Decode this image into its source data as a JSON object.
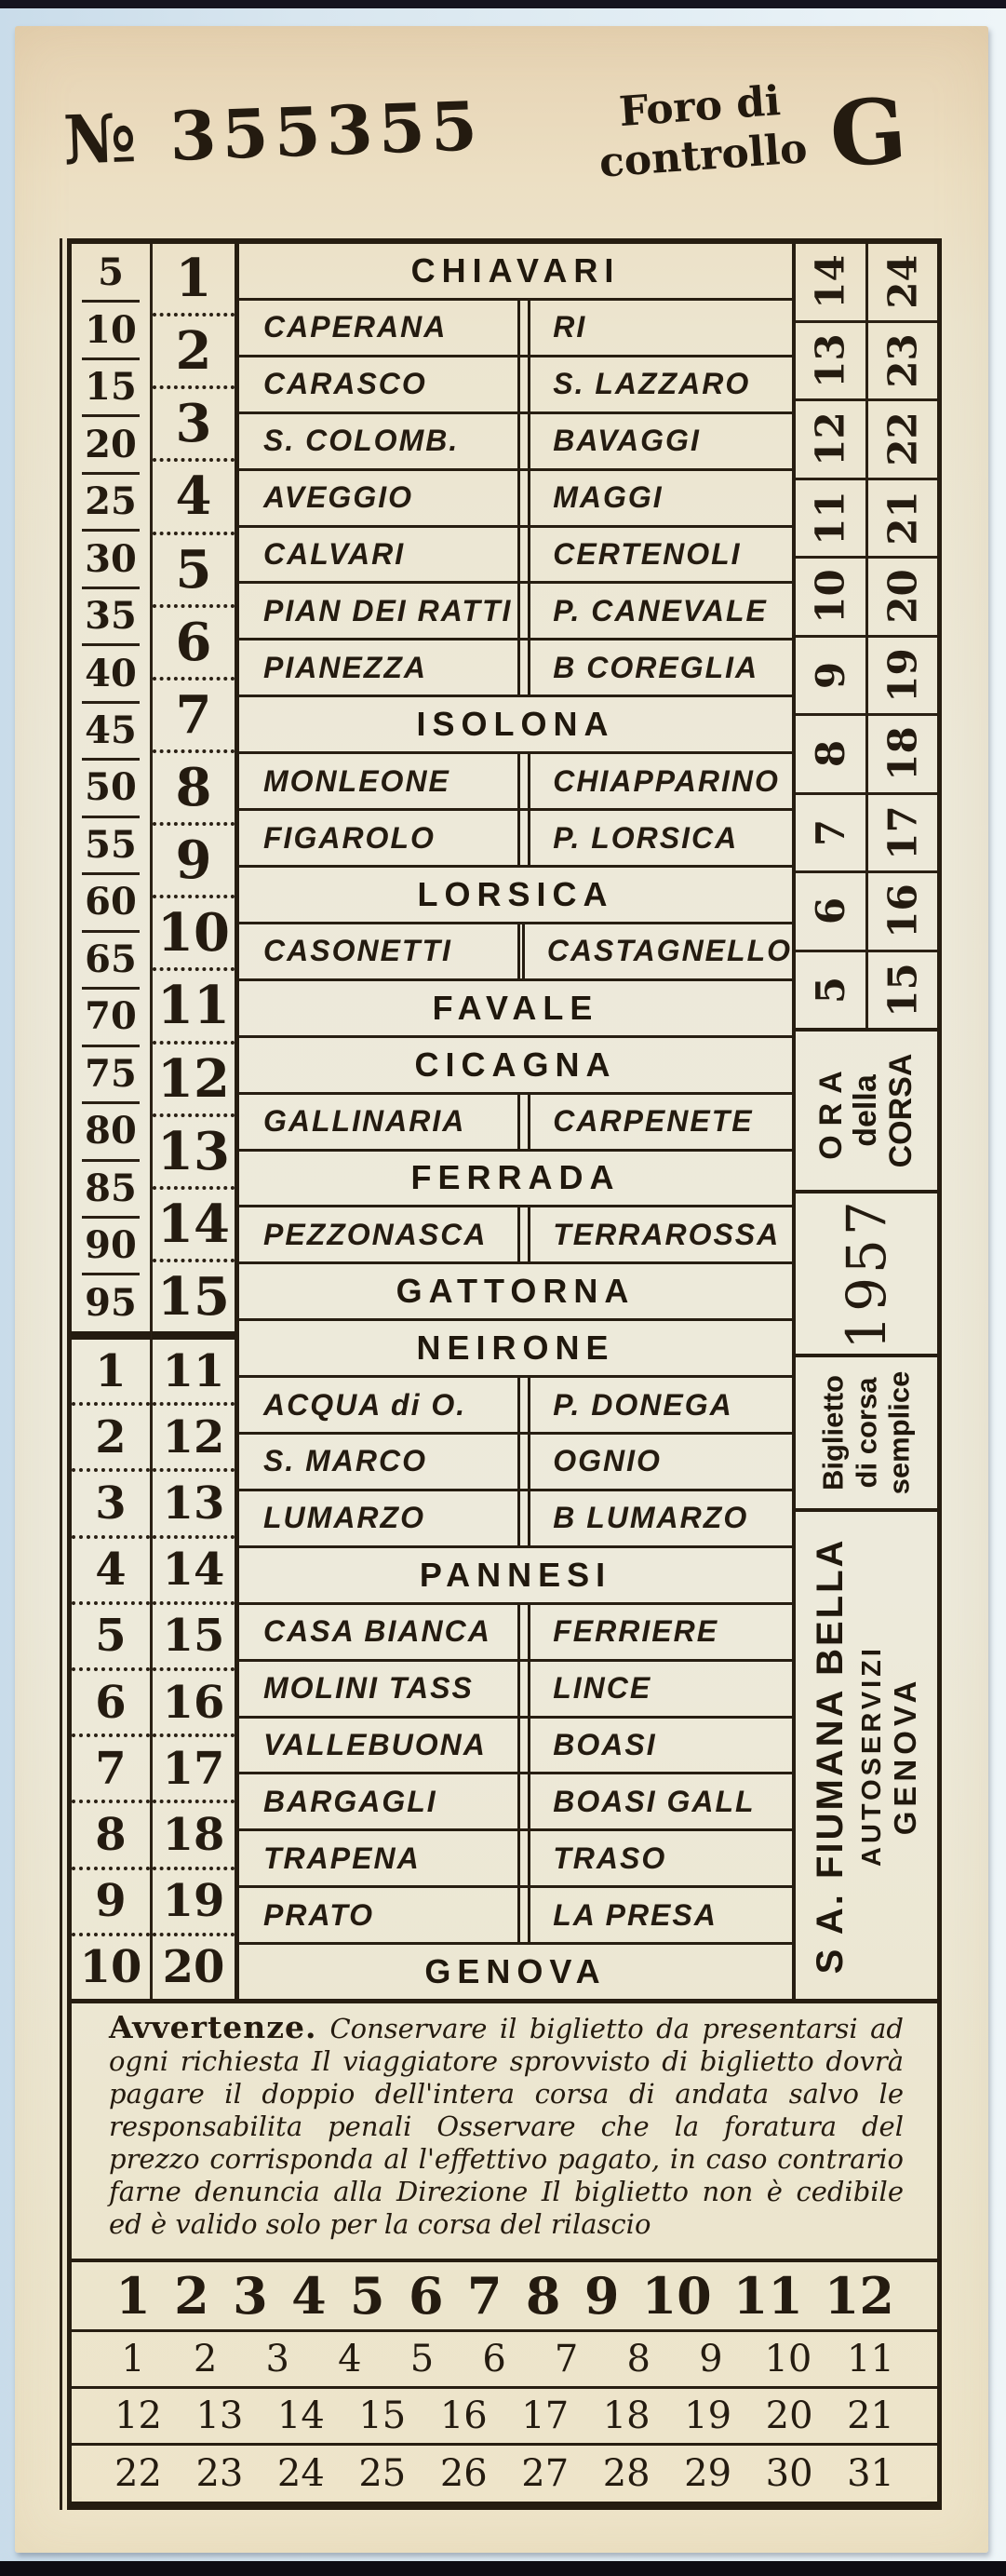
{
  "colors": {
    "paper": "#ece5cf",
    "ink": "#241b10",
    "background": "#d8e6ef"
  },
  "header": {
    "number_prefix": "№",
    "ticket_number": "355355",
    "control_stamp_line1": "Foro di",
    "control_stamp_line2": "controllo",
    "series_letter": "G"
  },
  "fare_table": {
    "fares_section_a": [
      "5",
      "10",
      "15",
      "20",
      "25",
      "30",
      "35",
      "40",
      "45",
      "50",
      "55",
      "60",
      "65",
      "70",
      "75",
      "80",
      "85",
      "90",
      "95"
    ],
    "trip_numbers_section_a": [
      "1",
      "2",
      "3",
      "4",
      "5",
      "6",
      "7",
      "8",
      "9",
      "10",
      "11",
      "12",
      "13",
      "14",
      "15"
    ],
    "fares_section_b": [
      "1",
      "2",
      "3",
      "4",
      "5",
      "6",
      "7",
      "8",
      "9",
      "10"
    ],
    "trip_numbers_section_b": [
      "11",
      "12",
      "13",
      "14",
      "15",
      "16",
      "17",
      "18",
      "19",
      "20"
    ],
    "stations": [
      {
        "type": "header",
        "name": "CHIAVARI"
      },
      {
        "type": "pair",
        "left": "CAPERANA",
        "right": "RI"
      },
      {
        "type": "pair",
        "left": "CARASCO",
        "right": "S. LAZZARO"
      },
      {
        "type": "pair",
        "left": "S. COLOMB.",
        "right": "BAVAGGI"
      },
      {
        "type": "pair",
        "left": "AVEGGIO",
        "right": "MAGGI"
      },
      {
        "type": "pair",
        "left": "CALVARI",
        "right": "CERTENOLI"
      },
      {
        "type": "pair",
        "left": "PIAN DEI RATTI",
        "right": "P. CANEVALE"
      },
      {
        "type": "pair",
        "left": "PIANEZZA",
        "right": "B COREGLIA"
      },
      {
        "type": "header",
        "name": "ISOLONA"
      },
      {
        "type": "pair",
        "left": "MONLEONE",
        "right": "CHIAPPARINO"
      },
      {
        "type": "pair",
        "left": "FIGAROLO",
        "right": "P. LORSICA"
      },
      {
        "type": "header",
        "name": "LORSICA"
      },
      {
        "type": "pair",
        "left": "CASONETTI",
        "right": "CASTAGNELLO"
      },
      {
        "type": "header",
        "name": "FAVALE"
      },
      {
        "type": "header",
        "name": "CICAGNA"
      },
      {
        "type": "pair",
        "left": "GALLINARIA",
        "right": "CARPENETE"
      },
      {
        "type": "header",
        "name": "FERRADA"
      },
      {
        "type": "pair",
        "left": "PEZZONASCA",
        "right": "TERRAROSSA"
      },
      {
        "type": "header",
        "name": "GATTORNA"
      },
      {
        "type": "header",
        "name": "NEIRONE"
      },
      {
        "type": "pair",
        "left": "ACQUA di O.",
        "right": "P. DONEGA"
      },
      {
        "type": "pair",
        "left": "S. MARCO",
        "right": "OGNIO"
      },
      {
        "type": "pair",
        "left": "LUMARZO",
        "right": "B LUMARZO"
      },
      {
        "type": "header",
        "name": "PANNESI"
      },
      {
        "type": "pair",
        "left": "CASA BIANCA",
        "right": "FERRIERE"
      },
      {
        "type": "pair",
        "left": "MOLINI TASS",
        "right": "LINCE"
      },
      {
        "type": "pair",
        "left": "VALLEBUONA",
        "right": "BOASI"
      },
      {
        "type": "pair",
        "left": "BARGAGLI",
        "right": "BOASI GALL"
      },
      {
        "type": "pair",
        "left": "TRAPENA",
        "right": "TRASO"
      },
      {
        "type": "pair",
        "left": "PRATO",
        "right": "LA PRESA"
      },
      {
        "type": "header",
        "name": "GENOVA"
      }
    ],
    "right_numbers_inner": [
      "14",
      "13",
      "12",
      "11",
      "10",
      "9",
      "8",
      "7",
      "6",
      "5"
    ],
    "right_numbers_outer": [
      "24",
      "23",
      "22",
      "21",
      "20",
      "19",
      "18",
      "17",
      "16",
      "15"
    ],
    "ora_label_line1": "ORA",
    "ora_label_line2": "della",
    "ora_label_line3": "CORSA",
    "year": "1957",
    "ticket_type_line1": "Biglietto",
    "ticket_type_line2": "di corsa",
    "ticket_type_line3": "semplice",
    "company_line1": "S A. FIUMANA BELLA",
    "company_line2": "AUTOSERVIZI",
    "company_line3": "GENOVA"
  },
  "notice": {
    "title": "Avvertenze.",
    "body": "Conservare il biglietto da presentarsi ad ogni richiesta  Il viaggiatore sprovvisto di biglietto dovrà pagare il doppio dell'intera corsa di andata salvo le responsabilita penali  Osservare che la foratura del prezzo corrisponda al l'effettivo pagato, in caso contrario farne denuncia alla Direzione   Il biglietto non è cedibile ed è valido solo per la corsa del rilascio"
  },
  "date_grid": {
    "bold_row": [
      "1",
      "2",
      "3",
      "4",
      "5",
      "6",
      "7",
      "8",
      "9",
      "10",
      "11",
      "12"
    ],
    "row2": [
      "1",
      "2",
      "3",
      "4",
      "5",
      "6",
      "7",
      "8",
      "9",
      "10",
      "11"
    ],
    "row3": [
      "12",
      "13",
      "14",
      "15",
      "16",
      "17",
      "18",
      "19",
      "20",
      "21"
    ],
    "row4": [
      "22",
      "23",
      "24",
      "25",
      "26",
      "27",
      "28",
      "29",
      "30",
      "31"
    ]
  }
}
